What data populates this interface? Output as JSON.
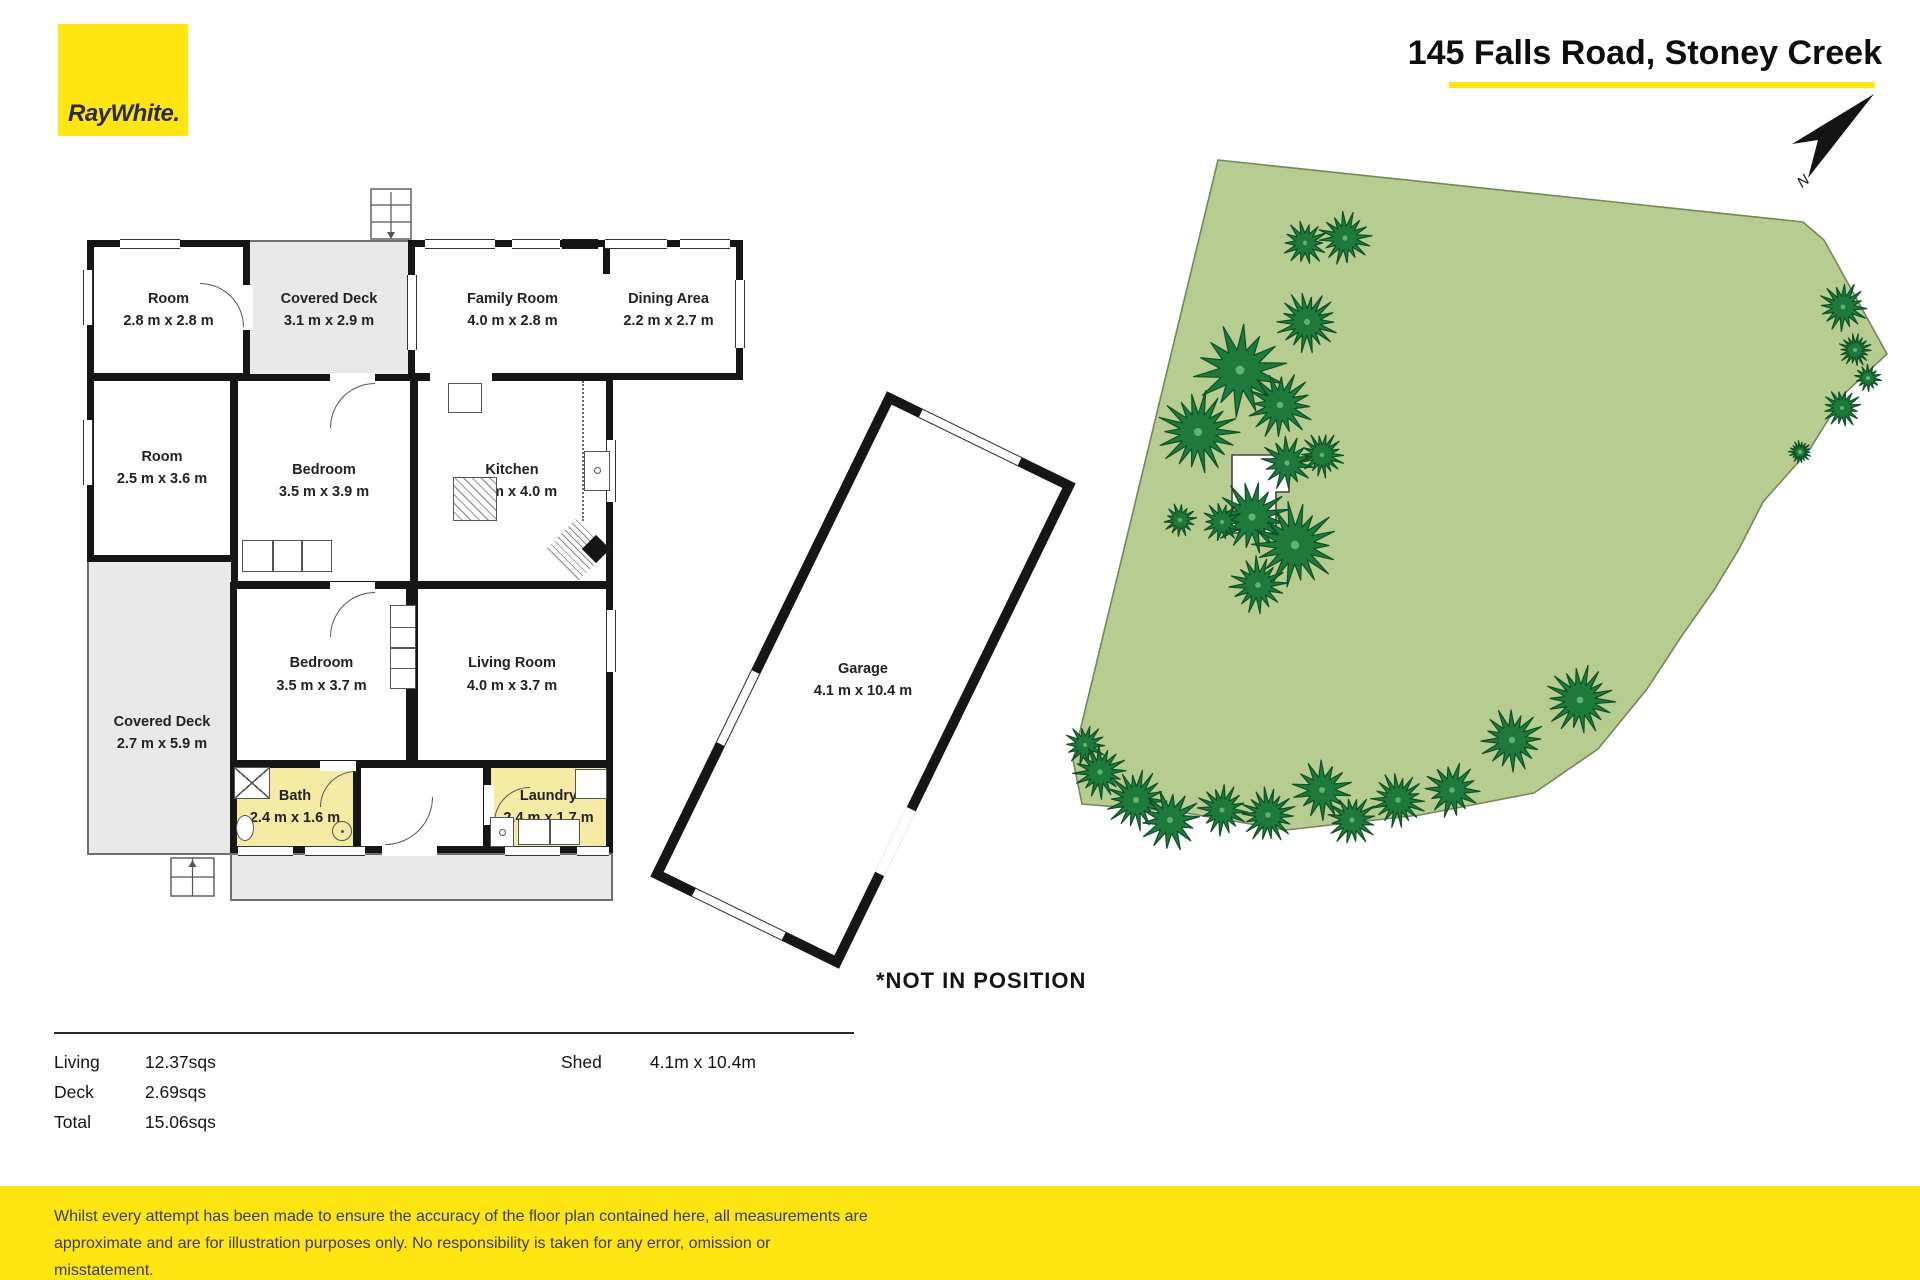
{
  "brand": {
    "logo_text": "RayWhite.",
    "yellow": "#ffe512"
  },
  "header": {
    "title": "145 Falls Road, Stoney Creek"
  },
  "north": {
    "label": "N"
  },
  "floorplan": {
    "rooms": [
      {
        "name": "Room",
        "dims": "2.8 m x 2.8 m"
      },
      {
        "name": "Covered Deck",
        "dims": "3.1 m x 2.9 m"
      },
      {
        "name": "Family Room",
        "dims": "4.0 m x 2.8 m"
      },
      {
        "name": "Dining Area",
        "dims": "2.2 m x 2.7 m"
      },
      {
        "name": "Room",
        "dims": "2.5 m x 3.6 m"
      },
      {
        "name": "Bedroom",
        "dims": "3.5 m x 3.9 m"
      },
      {
        "name": "Kitchen",
        "dims": "4.0 m x 4.0 m"
      },
      {
        "name": "Covered Deck",
        "dims": "2.7 m x 5.9 m"
      },
      {
        "name": "Bedroom",
        "dims": "3.5 m x 3.7 m"
      },
      {
        "name": "Living Room",
        "dims": "4.0 m x 3.7 m"
      },
      {
        "name": "Bath",
        "dims": "2.4 m x 1.6 m"
      },
      {
        "name": "Laundry",
        "dims": "2.4 m x 1.7 m"
      }
    ],
    "garage": {
      "name": "Garage",
      "dims": "4.1 m x 10.4 m",
      "note": "*NOT IN POSITION"
    }
  },
  "summary": {
    "rows": [
      {
        "label": "Living",
        "value": "12.37sqs"
      },
      {
        "label": "Deck",
        "value": "2.69sqs"
      },
      {
        "label": "Total",
        "value": "15.06sqs"
      }
    ],
    "shed_label": "Shed",
    "shed_value": "4.1m x 10.4m"
  },
  "footer": {
    "lines": [
      "Whilst every attempt has been made to ensure the accuracy of the floor plan contained here, all measurements are",
      "approximate and are for illustration purposes only. No responsibility is taken for any error, omission or",
      "misstatement."
    ]
  },
  "colors": {
    "land_green": "#b6cc90",
    "land_edge": "#75865a",
    "tree_green": "#1e7a3b",
    "tree_edge": "#0d4f26",
    "wet_room": "#f6eba4",
    "deck_gray": "#e9e9e9"
  }
}
